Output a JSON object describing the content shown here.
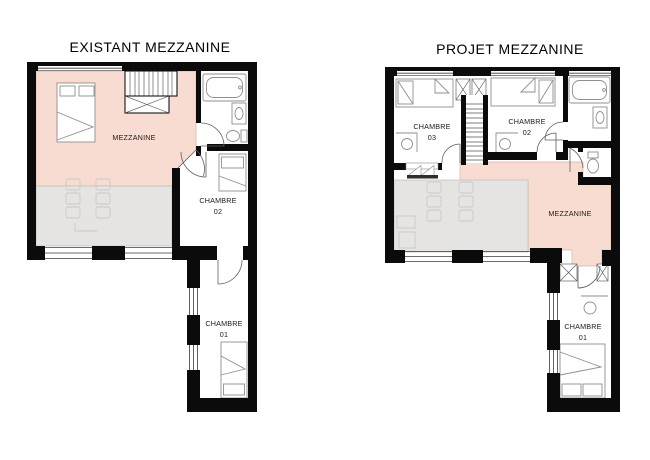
{
  "colors": {
    "mezzanine_fill": "#f8dcd2",
    "mezzanine_stroke": "#d8b3a6",
    "void_fill": "#e5e4e3",
    "void_stroke": "#bdbcbb",
    "wall": "#0b0b0b",
    "furniture": "#8f8f8f",
    "faint": "#c9c8c7",
    "text": "#1c1c1c"
  },
  "plans": {
    "existant": {
      "title": "EXISTANT MEZZANINE",
      "labels": {
        "mezzanine": "MEZZANINE",
        "chambre02_l1": "CHAMBRE",
        "chambre02_l2": "02",
        "chambre01_l1": "CHAMBRE",
        "chambre01_l2": "01"
      }
    },
    "projet": {
      "title": "PROJET MEZZANINE",
      "labels": {
        "mezzanine": "MEZZANINE",
        "chambre03_l1": "CHAMBRE",
        "chambre03_l2": "03",
        "chambre02_l1": "CHAMBRE",
        "chambre02_l2": "02",
        "chambre01_l1": "CHAMBRE",
        "chambre01_l2": "01"
      }
    }
  }
}
